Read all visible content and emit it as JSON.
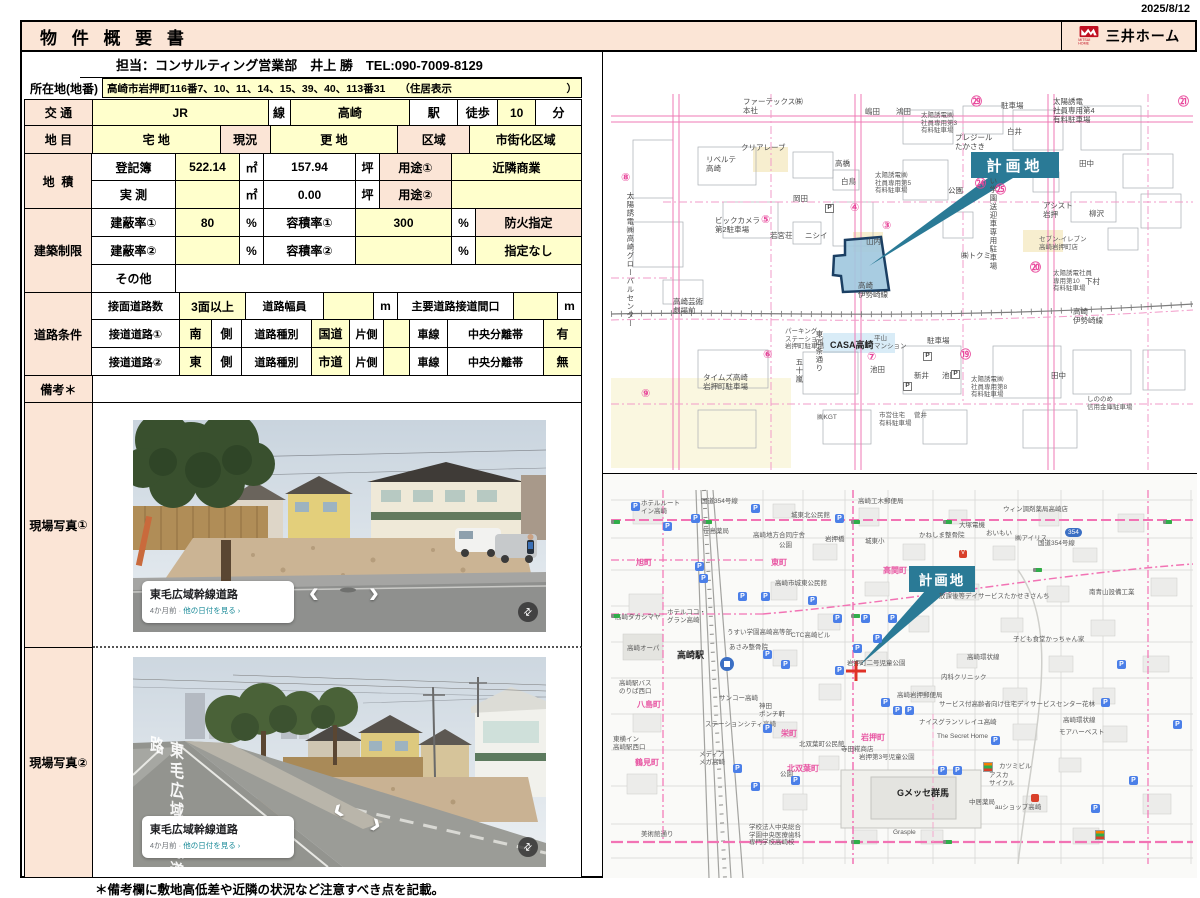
{
  "page": {
    "date": "2025/8/12",
    "note": "＊備考欄に敷地高低差や近隣の状況など注意すべき点を記載。"
  },
  "header": {
    "title": "物 件 概 要 書",
    "brand": "三井ホーム",
    "brand_sub": "MITSUI HOME"
  },
  "contact": {
    "line": "担当：コンサルティング営業部　井上 勝　TEL:090-7009-8129"
  },
  "location": {
    "label": "所在地(地番)",
    "value": "高崎市岩押町116番7、10、11、14、15、39、40、113番31",
    "jusho": "（住居表示",
    "close": "）"
  },
  "units": {
    "m2": "㎡",
    "tsubo": "坪",
    "percent": "%",
    "m": "m",
    "side": "側",
    "lane": "車線",
    "median": "中央分離帯",
    "road_type": "道路種別",
    "one_side": "片側"
  },
  "transport": {
    "label": "交  通",
    "line_value": "JR",
    "line_suffix": "線",
    "station_value": "高崎",
    "station_suffix": "駅",
    "walk_label": "徒歩",
    "walk_value": "10",
    "walk_unit": "分"
  },
  "land": {
    "category_label": "地  目",
    "category_value": "宅 地",
    "status_label": "現況",
    "status_value": "更 地",
    "zone_label": "区域",
    "zone_value": "市街化区域",
    "area_label": "地  積",
    "registry_label": "登記簿",
    "registry_m2": "522.14",
    "registry_tsubo": "157.94",
    "survey_label": "実 測",
    "survey_m2": "",
    "survey_tsubo": "0.00",
    "use1_label": "用途①",
    "use1_value": "近隣商業",
    "use2_label": "用途②",
    "use2_value": ""
  },
  "restrictions": {
    "label": "建築制限",
    "bcr1_label": "建蔽率①",
    "bcr1_value": "80",
    "far1_label": "容積率①",
    "far1_value": "300",
    "fire_label": "防火指定",
    "bcr2_label": "建蔽率②",
    "bcr2_value": "",
    "far2_label": "容積率②",
    "far2_value": "",
    "fire_value": "指定なし",
    "other_label": "その他",
    "other_value": ""
  },
  "roads": {
    "label": "道路条件",
    "count_label": "接面道路数",
    "count_value": "3面以上",
    "width_label": "道路幅員",
    "width_value": "",
    "frontage_label": "主要道路接道間口",
    "frontage_value": "",
    "road1_label": "接道道路①",
    "road1_dir": "南",
    "road1_type": "国道",
    "road1_lanes": "",
    "road1_median": "有",
    "road2_label": "接道道路②",
    "road2_dir": "東",
    "road2_type": "市道",
    "road2_lanes": "",
    "road2_median": "無"
  },
  "remarks": {
    "label": "備考＊",
    "value": ""
  },
  "photos": {
    "label": "現場写真",
    "num1": "①",
    "num2": "②",
    "caption_title": "東毛広域幹線道路",
    "caption_ago": "4か月前",
    "caption_sep": " · ",
    "caption_link": "他の日付を見る ›",
    "road_paint": "東毛広域幹線道路"
  },
  "maps": {
    "plan_label": "計画地",
    "colors": {
      "accent_teal": "#2a7a96",
      "parcel_fill": "#9fc6de",
      "parcel_border": "#1b3f63",
      "road_pink": "#ef79b4",
      "brand_red": "#c00e20",
      "peach": "#fbe5d6",
      "yellow": "#ffffcc"
    },
    "top_labels": [
      {
        "x": 140,
        "y": 46,
        "t": "ファーテックス㈱\n本社"
      },
      {
        "x": 262,
        "y": 56,
        "t": "嶋田"
      },
      {
        "x": 293,
        "y": 56,
        "t": "鴻田"
      },
      {
        "x": 318,
        "y": 60,
        "t": "太陽誘電㈱\n社員専用第3\n有料駐車場",
        "c": "t6"
      },
      {
        "x": 398,
        "y": 50,
        "t": "駐車場"
      },
      {
        "x": 450,
        "y": 46,
        "t": "太陽誘電\n社員専用第4\n有料駐車場"
      },
      {
        "x": 352,
        "y": 82,
        "t": "プレジール\nたかさき"
      },
      {
        "x": 404,
        "y": 76,
        "t": "白井"
      },
      {
        "x": 476,
        "y": 108,
        "t": "田中"
      },
      {
        "x": 103,
        "y": 104,
        "t": "リベルテ\n高崎"
      },
      {
        "x": 138,
        "y": 92,
        "t": "クリアレーブ"
      },
      {
        "x": 232,
        "y": 108,
        "t": "高橋"
      },
      {
        "x": 238,
        "y": 126,
        "t": "白鳥"
      },
      {
        "x": 190,
        "y": 143,
        "t": "岡田"
      },
      {
        "x": 112,
        "y": 165,
        "t": "ビックカメラ\n第2駐車場"
      },
      {
        "x": 167,
        "y": 180,
        "t": "若宮荘"
      },
      {
        "x": 202,
        "y": 180,
        "t": "ニシイ"
      },
      {
        "x": 263,
        "y": 186,
        "t": "山内"
      },
      {
        "x": 272,
        "y": 120,
        "t": "太陽誘電㈱\n社員専用第5\n有料駐車場",
        "c": "t6"
      },
      {
        "x": 345,
        "y": 135,
        "t": "公園"
      },
      {
        "x": 385,
        "y": 108,
        "t": "うすい学園送迎車専用駐車場",
        "c": "v"
      },
      {
        "x": 440,
        "y": 150,
        "t": "アシスト\n岩押"
      },
      {
        "x": 486,
        "y": 158,
        "t": "柳沢"
      },
      {
        "x": 18,
        "y": 120,
        "t": "⑧",
        "c": "cn"
      },
      {
        "x": 158,
        "y": 162,
        "t": "⑤",
        "c": "cn"
      },
      {
        "x": 247,
        "y": 150,
        "t": "④",
        "c": "cn"
      },
      {
        "x": 279,
        "y": 168,
        "t": "③",
        "c": "cn"
      },
      {
        "x": 372,
        "y": 126,
        "t": "㉔",
        "c": "cn"
      },
      {
        "x": 392,
        "y": 132,
        "t": "㉕",
        "c": "cn"
      },
      {
        "x": 368,
        "y": 44,
        "t": "㉙",
        "c": "cn"
      },
      {
        "x": 575,
        "y": 44,
        "t": "㉑",
        "c": "cn"
      },
      {
        "x": 22,
        "y": 140,
        "t": "太陽誘電㈱高崎グローバルセンター",
        "c": "v"
      },
      {
        "x": 358,
        "y": 200,
        "t": "㈱トクミ"
      },
      {
        "x": 427,
        "y": 210,
        "t": "⑳",
        "c": "cn"
      },
      {
        "x": 482,
        "y": 226,
        "t": "下村"
      },
      {
        "x": 450,
        "y": 218,
        "t": "太陽誘電社員\n専用第10\n有料駐車場",
        "c": "t6"
      },
      {
        "x": 436,
        "y": 184,
        "t": "セブン-イレブン\n高崎岩押町店",
        "c": "t6"
      },
      {
        "x": 70,
        "y": 246,
        "t": "高崎芸術\n劇場前"
      },
      {
        "x": 255,
        "y": 230,
        "t": "高崎\n伊勢崎線"
      },
      {
        "x": 470,
        "y": 256,
        "t": "高崎\n伊勢崎線"
      },
      {
        "x": 160,
        "y": 297,
        "t": "⑥",
        "c": "cn"
      },
      {
        "x": 182,
        "y": 276,
        "t": "パーキング\nステーション\n岩押町駐車場",
        "c": "t6"
      },
      {
        "x": 100,
        "y": 322,
        "t": "タイムズ高崎\n岩押町駐車場"
      },
      {
        "x": 191,
        "y": 306,
        "t": "五十嵐",
        "c": "v"
      },
      {
        "x": 211,
        "y": 278,
        "t": "東四条通り",
        "c": "v"
      },
      {
        "x": 227,
        "y": 288,
        "t": "CASA高崎",
        "c": "b"
      },
      {
        "x": 271,
        "y": 283,
        "t": "平山\nマンション",
        "c": "t6"
      },
      {
        "x": 264,
        "y": 299,
        "t": "⑦",
        "c": "cn"
      },
      {
        "x": 267,
        "y": 314,
        "t": "池田"
      },
      {
        "x": 324,
        "y": 285,
        "t": "駐車場"
      },
      {
        "x": 311,
        "y": 320,
        "t": "新井"
      },
      {
        "x": 339,
        "y": 320,
        "t": "池田"
      },
      {
        "x": 357,
        "y": 297,
        "t": "⑲",
        "c": "cn"
      },
      {
        "x": 368,
        "y": 324,
        "t": "太陽誘電㈱\n社員専用第8\n有料駐車場",
        "c": "t6"
      },
      {
        "x": 448,
        "y": 320,
        "t": "田中"
      },
      {
        "x": 484,
        "y": 344,
        "t": "しののめ\n信用金庫駐車場",
        "c": "t6"
      },
      {
        "x": 38,
        "y": 336,
        "t": "⑨",
        "c": "cn"
      },
      {
        "x": 276,
        "y": 360,
        "t": "市営住宅\n有料駐車場",
        "c": "t6"
      },
      {
        "x": 214,
        "y": 362,
        "t": "㈱KGT",
        "c": "t6"
      },
      {
        "x": 311,
        "y": 360,
        "t": "菅井",
        "c": "t6"
      },
      {
        "x": 222,
        "y": 152,
        "t": "P",
        "c": "pm2"
      },
      {
        "x": 320,
        "y": 300,
        "t": "P",
        "c": "pm2"
      },
      {
        "x": 348,
        "y": 318,
        "t": "P",
        "c": "pm2"
      },
      {
        "x": 300,
        "y": 330,
        "t": "P",
        "c": "pm2"
      }
    ],
    "bottom_labels": [
      {
        "x": 38,
        "y": 26,
        "t": "ホテルルート\nイン高崎",
        "c": "t6"
      },
      {
        "x": 98,
        "y": 24,
        "t": "国道354号線",
        "c": "t6"
      },
      {
        "x": 188,
        "y": 38,
        "t": "城東北公民館",
        "c": "t6"
      },
      {
        "x": 100,
        "y": 54,
        "t": "笹島薬局",
        "c": "t6"
      },
      {
        "x": 150,
        "y": 58,
        "t": "高崎地方合同庁舎",
        "c": "t6"
      },
      {
        "x": 176,
        "y": 68,
        "t": "公園",
        "c": "t6"
      },
      {
        "x": 255,
        "y": 24,
        "t": "高崎工木郵便局",
        "c": "t6"
      },
      {
        "x": 262,
        "y": 64,
        "t": "城東小",
        "c": "t6"
      },
      {
        "x": 222,
        "y": 62,
        "t": "岩押橋",
        "c": "t6"
      },
      {
        "x": 316,
        "y": 58,
        "t": "かねしま整骨院",
        "c": "t6"
      },
      {
        "x": 356,
        "y": 48,
        "t": "大塚電機",
        "c": "t6"
      },
      {
        "x": 383,
        "y": 56,
        "t": "おいもい",
        "c": "t6"
      },
      {
        "x": 400,
        "y": 32,
        "t": "ウィン調剤薬局高崎店",
        "c": "t6"
      },
      {
        "x": 412,
        "y": 61,
        "t": "㈱アイリス",
        "c": "t6"
      },
      {
        "x": 435,
        "y": 66,
        "t": "国道354号線",
        "c": "t6"
      },
      {
        "x": 462,
        "y": 54,
        "t": "354",
        "c": "bd"
      },
      {
        "x": 168,
        "y": 84,
        "t": "東町",
        "c": "p"
      },
      {
        "x": 33,
        "y": 84,
        "t": "旭町",
        "c": "p"
      },
      {
        "x": 280,
        "y": 92,
        "t": "高関町",
        "c": "p"
      },
      {
        "x": 172,
        "y": 106,
        "t": "高崎市城東公民館",
        "c": "t6"
      },
      {
        "x": 336,
        "y": 119,
        "t": "放課後等デイサービスたかせきさんち",
        "c": "t6"
      },
      {
        "x": 486,
        "y": 115,
        "t": "南青山設備工業",
        "c": "t6"
      },
      {
        "x": 64,
        "y": 135,
        "t": "ホテルココ・\nグラン高崎",
        "c": "t6"
      },
      {
        "x": 12,
        "y": 140,
        "t": "高崎タカシマヤ",
        "c": "t6"
      },
      {
        "x": 124,
        "y": 155,
        "t": "うすい学園高崎高等部",
        "c": "t6"
      },
      {
        "x": 188,
        "y": 158,
        "t": "CTC高崎ビル",
        "c": "t6"
      },
      {
        "x": 410,
        "y": 162,
        "t": "子ども食堂かっちゃん家",
        "c": "t6"
      },
      {
        "x": 24,
        "y": 171,
        "t": "高崎オーパ",
        "c": "t6"
      },
      {
        "x": 74,
        "y": 176,
        "t": "高崎駅",
        "c": "b"
      },
      {
        "x": 126,
        "y": 170,
        "t": "あさみ整骨院",
        "c": "t6"
      },
      {
        "x": 364,
        "y": 180,
        "t": "高崎環状線",
        "c": "t6"
      },
      {
        "x": 244,
        "y": 186,
        "t": "岩押町二号児童公園",
        "c": "t6"
      },
      {
        "x": 338,
        "y": 200,
        "t": "内科クリニック",
        "c": "t6"
      },
      {
        "x": 16,
        "y": 206,
        "t": "高崎駅バス\nのりば西口",
        "c": "t6"
      },
      {
        "x": 34,
        "y": 226,
        "t": "八島町",
        "c": "p"
      },
      {
        "x": 116,
        "y": 221,
        "t": "サンコー高崎",
        "c": "t6"
      },
      {
        "x": 156,
        "y": 229,
        "t": "神田\nポンチ軒",
        "c": "t6"
      },
      {
        "x": 294,
        "y": 218,
        "t": "高崎岩押郵便局",
        "c": "t6"
      },
      {
        "x": 336,
        "y": 227,
        "t": "サービス付高齢者向け住宅デイサービスセンター花林",
        "c": "t6"
      },
      {
        "x": 316,
        "y": 245,
        "t": "ナイスグランソレイユ高崎",
        "c": "t6"
      },
      {
        "x": 460,
        "y": 243,
        "t": "高崎環状線",
        "c": "t6"
      },
      {
        "x": 334,
        "y": 259,
        "t": "The Secret Home",
        "c": "t6"
      },
      {
        "x": 456,
        "y": 255,
        "t": "モアハーベスト",
        "c": "t6"
      },
      {
        "x": 102,
        "y": 247,
        "t": "ステーションシティ高崎",
        "c": "t6"
      },
      {
        "x": 10,
        "y": 262,
        "t": "東横イン\n高崎駅西口",
        "c": "t6"
      },
      {
        "x": 32,
        "y": 284,
        "t": "鶴見町",
        "c": "p"
      },
      {
        "x": 96,
        "y": 277,
        "t": "メディア\nメガ高崎",
        "c": "t6"
      },
      {
        "x": 178,
        "y": 255,
        "t": "栄町",
        "c": "p"
      },
      {
        "x": 196,
        "y": 267,
        "t": "北双葉町公民館",
        "c": "t6"
      },
      {
        "x": 238,
        "y": 272,
        "t": "寺田糀商店",
        "c": "t6"
      },
      {
        "x": 258,
        "y": 259,
        "t": "岩押町",
        "c": "p"
      },
      {
        "x": 256,
        "y": 280,
        "t": "岩押第3号児童公園",
        "c": "t6"
      },
      {
        "x": 184,
        "y": 290,
        "t": "北双葉町",
        "c": "p"
      },
      {
        "x": 177,
        "y": 297,
        "t": "公園",
        "c": "t6"
      },
      {
        "x": 294,
        "y": 314,
        "t": "Gメッセ群馬",
        "c": "b"
      },
      {
        "x": 386,
        "y": 298,
        "t": "アスカ\nサイクル",
        "c": "t6"
      },
      {
        "x": 396,
        "y": 289,
        "t": "カツミビル",
        "c": "t6"
      },
      {
        "x": 366,
        "y": 325,
        "t": "中居薬局",
        "c": "t6"
      },
      {
        "x": 392,
        "y": 330,
        "t": "auショップ高崎",
        "c": "t6"
      },
      {
        "x": 38,
        "y": 357,
        "t": "美術館通り",
        "c": "t6"
      },
      {
        "x": 146,
        "y": 350,
        "t": "学校法人中央総合\n学園中央医療歯科\n専門学校高崎校",
        "c": "t6"
      },
      {
        "x": 290,
        "y": 355,
        "t": "Grasple",
        "c": "t6"
      },
      {
        "x": 28,
        "y": 28,
        "t": "P",
        "c": "pm"
      },
      {
        "x": 60,
        "y": 48,
        "t": "P",
        "c": "pm"
      },
      {
        "x": 88,
        "y": 40,
        "t": "P",
        "c": "pm"
      },
      {
        "x": 148,
        "y": 30,
        "t": "P",
        "c": "pm"
      },
      {
        "x": 232,
        "y": 40,
        "t": "P",
        "c": "pm"
      },
      {
        "x": 92,
        "y": 88,
        "t": "P",
        "c": "pm"
      },
      {
        "x": 96,
        "y": 100,
        "t": "P",
        "c": "pm"
      },
      {
        "x": 135,
        "y": 118,
        "t": "P",
        "c": "pm"
      },
      {
        "x": 158,
        "y": 118,
        "t": "P",
        "c": "pm"
      },
      {
        "x": 205,
        "y": 122,
        "t": "P",
        "c": "pm"
      },
      {
        "x": 230,
        "y": 140,
        "t": "P",
        "c": "pm"
      },
      {
        "x": 258,
        "y": 140,
        "t": "P",
        "c": "pm"
      },
      {
        "x": 285,
        "y": 140,
        "t": "P",
        "c": "pm"
      },
      {
        "x": 250,
        "y": 170,
        "t": "P",
        "c": "pm"
      },
      {
        "x": 270,
        "y": 160,
        "t": "P",
        "c": "pm"
      },
      {
        "x": 160,
        "y": 176,
        "t": "P",
        "c": "pm"
      },
      {
        "x": 178,
        "y": 186,
        "t": "P",
        "c": "pm"
      },
      {
        "x": 232,
        "y": 192,
        "t": "P",
        "c": "pm"
      },
      {
        "x": 278,
        "y": 224,
        "t": "P",
        "c": "pm"
      },
      {
        "x": 290,
        "y": 232,
        "t": "P",
        "c": "pm"
      },
      {
        "x": 302,
        "y": 232,
        "t": "P",
        "c": "pm"
      },
      {
        "x": 160,
        "y": 250,
        "t": "P",
        "c": "pm"
      },
      {
        "x": 130,
        "y": 290,
        "t": "P",
        "c": "pm"
      },
      {
        "x": 148,
        "y": 308,
        "t": "P",
        "c": "pm"
      },
      {
        "x": 188,
        "y": 302,
        "t": "P",
        "c": "pm"
      },
      {
        "x": 388,
        "y": 262,
        "t": "P",
        "c": "pm"
      },
      {
        "x": 498,
        "y": 224,
        "t": "P",
        "c": "pm"
      },
      {
        "x": 526,
        "y": 302,
        "t": "P",
        "c": "pm"
      },
      {
        "x": 488,
        "y": 330,
        "t": "P",
        "c": "pm"
      },
      {
        "x": 570,
        "y": 246,
        "t": "P",
        "c": "pm"
      },
      {
        "x": 514,
        "y": 186,
        "t": "P",
        "c": "pm"
      },
      {
        "x": 335,
        "y": 292,
        "t": "P",
        "c": "pm"
      },
      {
        "x": 350,
        "y": 292,
        "t": "P",
        "c": "pm"
      },
      {
        "x": 8,
        "y": 46,
        "t": "",
        "c": "sg"
      },
      {
        "x": 100,
        "y": 46,
        "t": "",
        "c": "sg"
      },
      {
        "x": 248,
        "y": 46,
        "t": "",
        "c": "sg"
      },
      {
        "x": 340,
        "y": 46,
        "t": "",
        "c": "sg"
      },
      {
        "x": 8,
        "y": 140,
        "t": "",
        "c": "sg"
      },
      {
        "x": 248,
        "y": 140,
        "t": "",
        "c": "sg"
      },
      {
        "x": 248,
        "y": 366,
        "t": "",
        "c": "sg"
      },
      {
        "x": 340,
        "y": 366,
        "t": "",
        "c": "sg"
      },
      {
        "x": 430,
        "y": 94,
        "t": "",
        "c": "sg"
      },
      {
        "x": 560,
        "y": 46,
        "t": "",
        "c": "sg"
      },
      {
        "x": 380,
        "y": 288,
        "t": "",
        "c": "sev"
      },
      {
        "x": 492,
        "y": 356,
        "t": "",
        "c": "sev"
      },
      {
        "x": 356,
        "y": 76,
        "t": "V",
        "c": "pr"
      },
      {
        "x": 428,
        "y": 320,
        "t": "",
        "c": "pr"
      }
    ]
  }
}
